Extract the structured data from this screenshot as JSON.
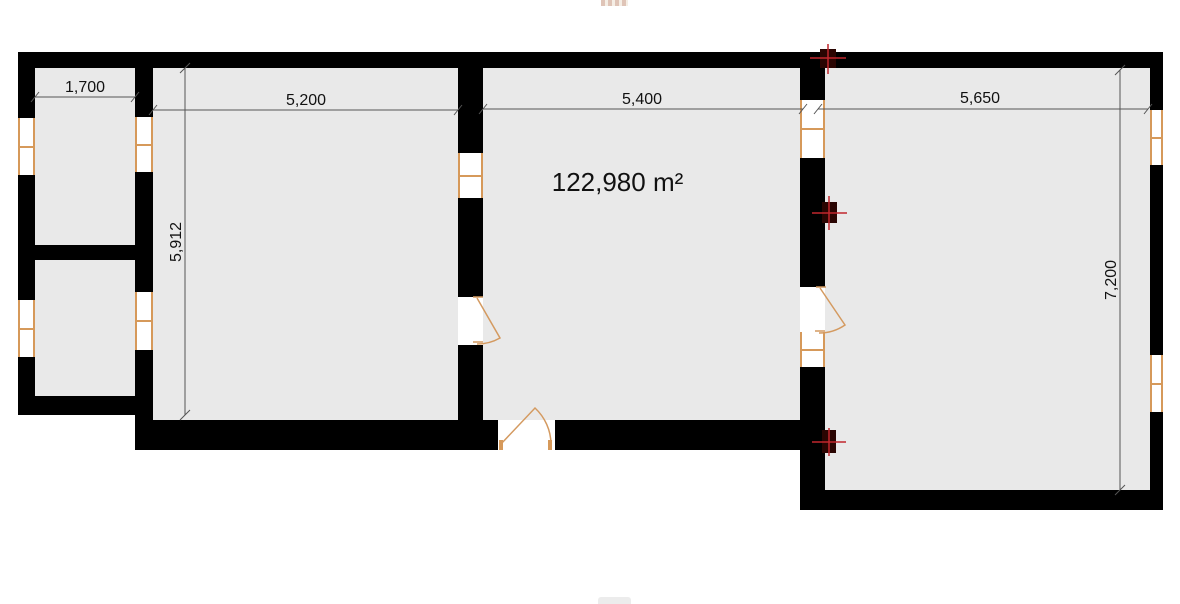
{
  "plan": {
    "type": "architectural-floor-plan",
    "area_label": "122,980 m²",
    "dimensions": {
      "entry_room_width": "1,700",
      "left_room_width": "5,200",
      "middle_room_width": "5,400",
      "right_room_width": "5,650",
      "left_room_height": "5,912",
      "right_room_height": "7,200"
    },
    "colors": {
      "wall": "#000000",
      "room_fill": "#e9e9e9",
      "window_frame": "#d6995a",
      "door_swing": "#d49a60",
      "dimension_line": "#555555",
      "marker_cross": "#c1272d",
      "marker_square": "#2a0502"
    }
  }
}
